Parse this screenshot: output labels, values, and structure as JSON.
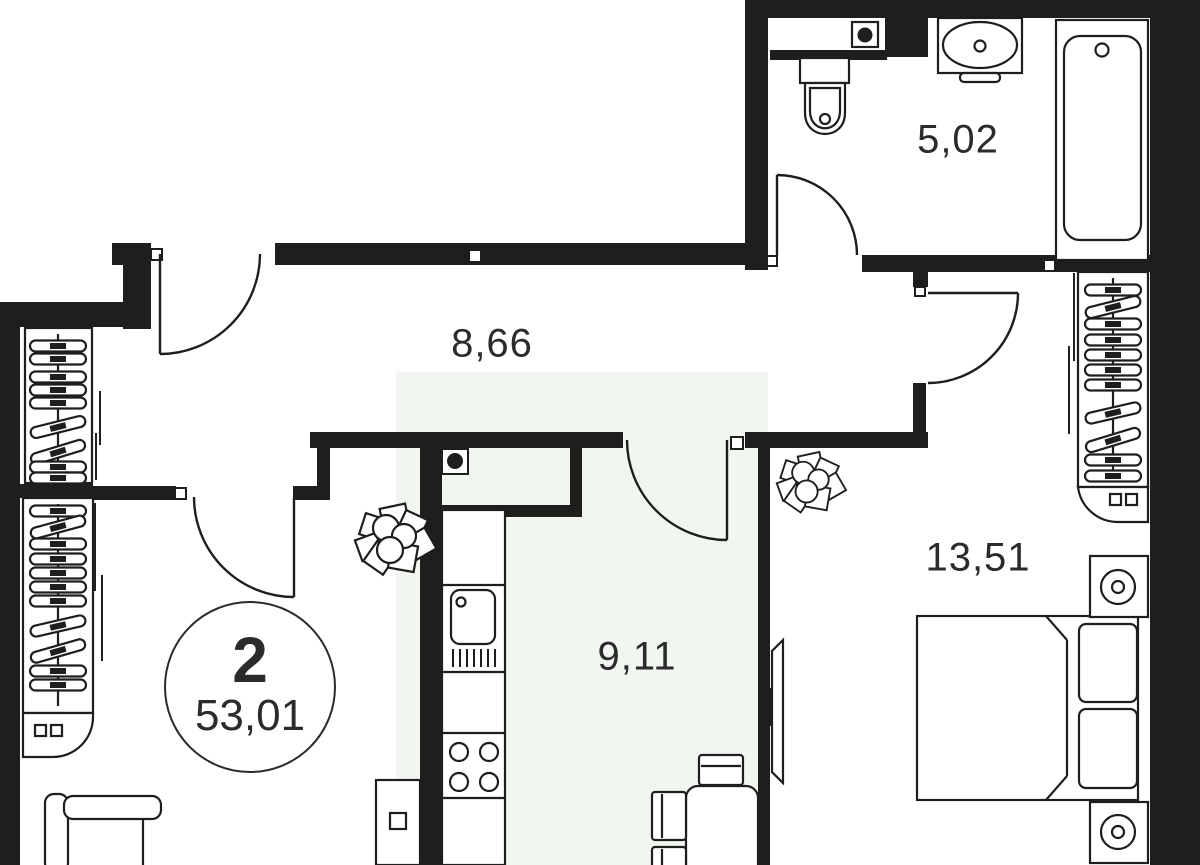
{
  "unit_badge": {
    "rooms": "2",
    "total_area": "53,01"
  },
  "rooms": [
    {
      "id": "bathroom",
      "area": "5,02"
    },
    {
      "id": "hallway",
      "area": "8,66"
    },
    {
      "id": "kitchen",
      "area": "9,11"
    },
    {
      "id": "bedroom",
      "area": "13,51"
    }
  ],
  "fixtures": [
    "entry-door-icon",
    "bathroom-door-icon",
    "living-room-door-icon",
    "kitchen-door-icon",
    "bedroom-door-icon",
    "toilet-icon",
    "washbasin-icon",
    "bathtub-icon",
    "ventilation-riser-icon",
    "wardrobe-hangers-icon",
    "sliding-door-icon",
    "kitchen-counter-icon",
    "kitchen-sink-icon",
    "stove-burners-icon",
    "dining-table-icon",
    "chair-icon",
    "sofa-icon",
    "tv-icon",
    "plant-icon",
    "bed-icon",
    "pillow-icon",
    "nightstand-lamp-icon"
  ],
  "colors": {
    "wall": "#1e1e1c",
    "line": "#1e1e1c",
    "paper": "#ffffff",
    "floor_tint": "#f1f6f1",
    "text": "#2b2b2b"
  }
}
